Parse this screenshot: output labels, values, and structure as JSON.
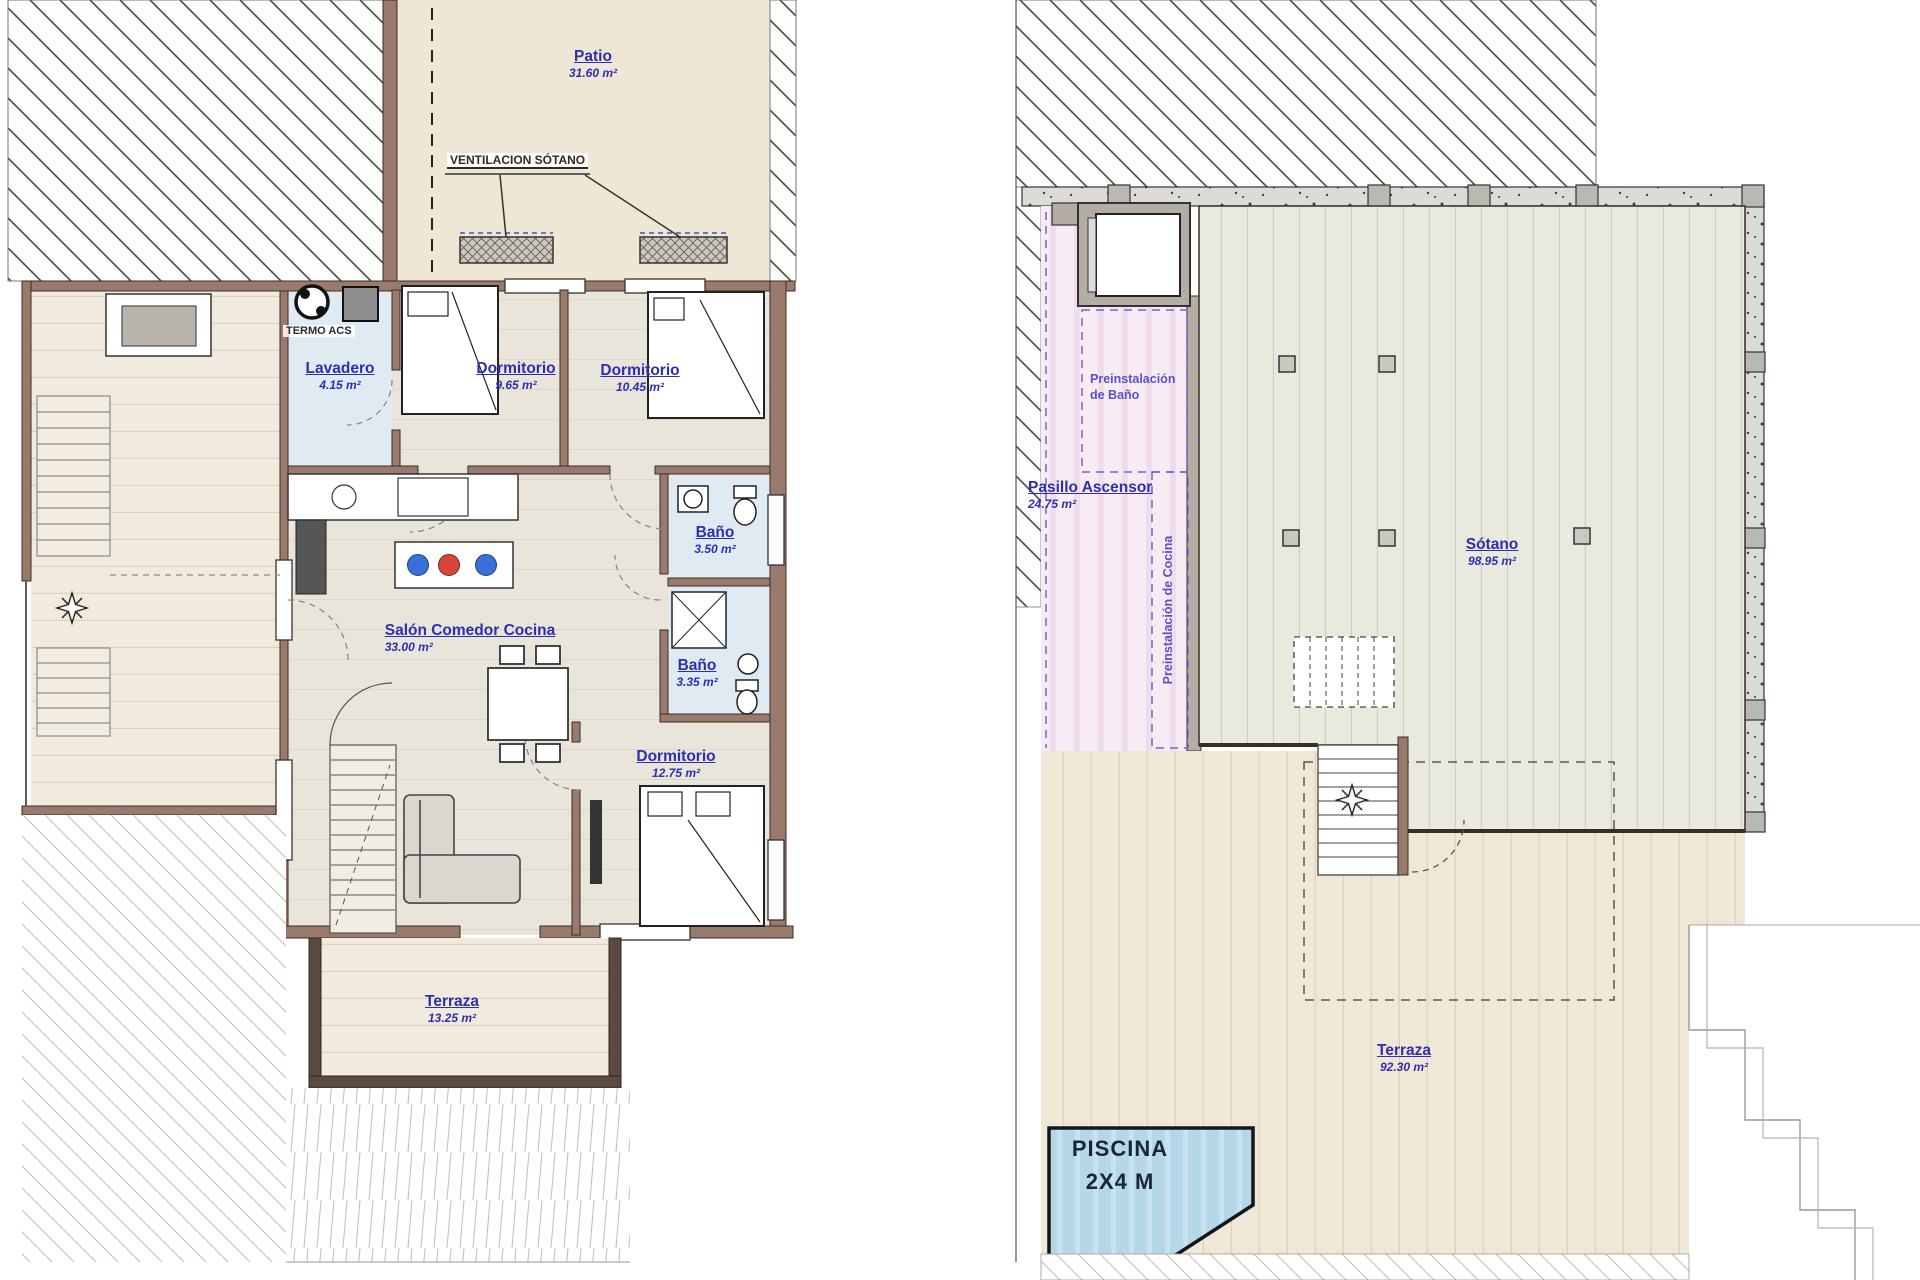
{
  "plan_left": {
    "patio": {
      "name": "Patio",
      "area": "31.60 m²"
    },
    "ventilacion": "VENTILACION SÓTANO",
    "termo": "TERMO ACS",
    "lavadero": {
      "name": "Lavadero",
      "area": "4.15 m²"
    },
    "dormitorio1": {
      "name": "Dormitorio",
      "area": "9.65 m²"
    },
    "dormitorio2": {
      "name": "Dormitorio",
      "area": "10.45 m²"
    },
    "bano1": {
      "name": "Baño",
      "area": "3.50 m²"
    },
    "salon": {
      "name": "Salón Comedor Cocina",
      "area": "33.00 m²"
    },
    "bano2": {
      "name": "Baño",
      "area": "3.35 m²"
    },
    "dormitorio3": {
      "name": "Dormitorio",
      "area": "12.75 m²"
    },
    "terraza": {
      "name": "Terraza",
      "area": "13.25 m²"
    }
  },
  "plan_right": {
    "preinst_bano": {
      "line1": "Preinstalación",
      "line2": "de Baño"
    },
    "pasillo": {
      "name": "Pasillo Ascensor",
      "area": "24.75 m²"
    },
    "preinst_cocina": "Preinstalación de Cocina",
    "sotano": {
      "name": "Sótano",
      "area": "98.95 m²"
    },
    "terraza": {
      "name": "Terraza",
      "area": "92.30 m²"
    },
    "piscina": {
      "line1": "PISCINA",
      "line2": "2X4 M"
    }
  },
  "colors": {
    "label_blue": "#2e2eb0",
    "preinstall_purple": "#5b50c8",
    "wall_brown": "#9b7a6e",
    "floor_beige": "#efe7d6",
    "floor_gray_green": "#e9e9de",
    "pink_zone": "#f8ecf4",
    "pool_blue": "#b5d8e9",
    "hob_red": "#d8453a",
    "hob_blue": "#3a6fd8",
    "bath_blue": "#dfeaf2"
  }
}
